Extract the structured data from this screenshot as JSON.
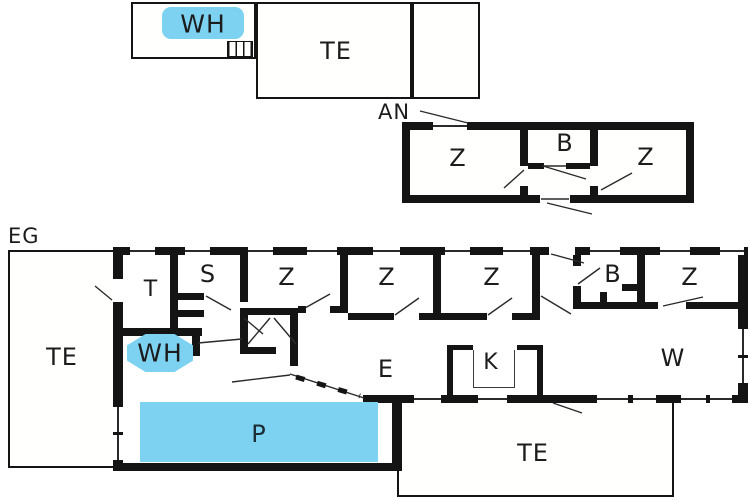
{
  "colors": {
    "highlight": "#7dd2f1",
    "wall": "#141414",
    "thin_line": "#2a2a2a",
    "text": "#1c1c1c",
    "background": "#ffffff"
  },
  "garage": {
    "wh": "WH",
    "te": "TE"
  },
  "annex": {
    "title": "AN",
    "z_left": "Z",
    "b": "B",
    "z_right": "Z"
  },
  "ground": {
    "title": "EG",
    "te_left": "TE",
    "t": "T",
    "s": "S",
    "z1": "Z",
    "z2": "Z",
    "z3": "Z",
    "b": "B",
    "z4": "Z",
    "wh": "WH",
    "e": "E",
    "k": "K",
    "w": "W",
    "p": "P",
    "te_bottom": "TE"
  }
}
